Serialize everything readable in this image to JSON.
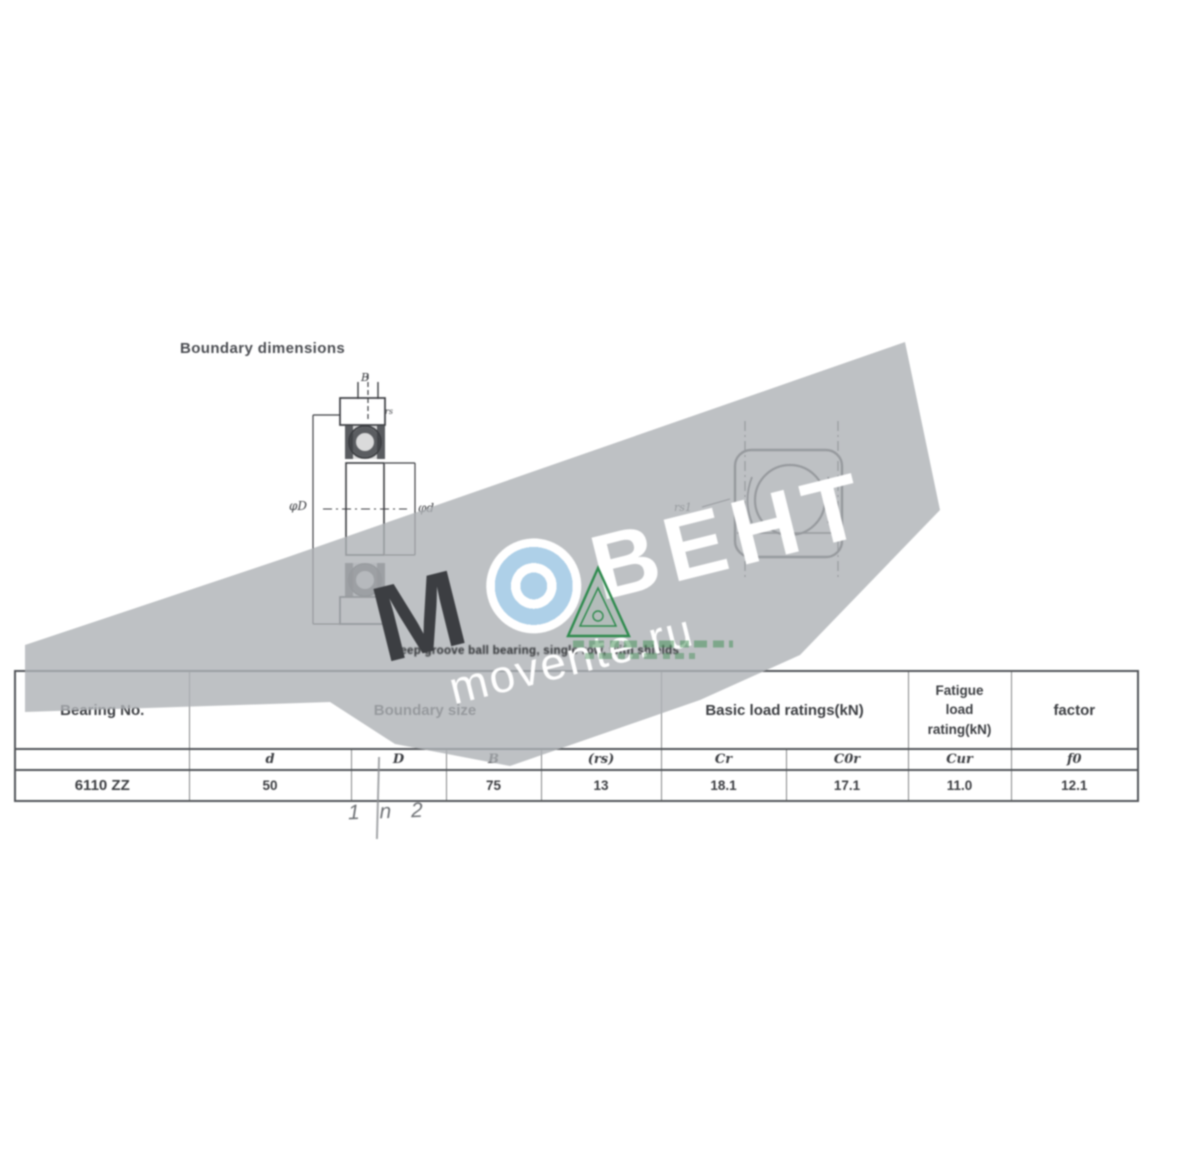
{
  "document": {
    "title": "Boundary dimensions",
    "caption": "deep groove ball bearing, single row, with shields",
    "pencil_note": "1 n 2"
  },
  "watermark": {
    "letter_m": "М",
    "brand": "ВЕНТ",
    "url": "movente.ru",
    "band_color": "#aeb2b5",
    "logo_blue": "#aed0e8",
    "logo_green": "#2f8b4e"
  },
  "drawing_left": {
    "dim_width": "B",
    "dim_outer": "φD",
    "dim_bore": "φd",
    "dim_r": "rs"
  },
  "drawing_right": {
    "dim_r1": "rs1"
  },
  "table": {
    "headers": {
      "bearing_no": "Bearing No.",
      "boundary_size": "Boundary size",
      "basic_load": "Basic load ratings(kN)",
      "fatigue": [
        "Fatigue",
        "load",
        "rating(kN)"
      ],
      "factor": "factor"
    },
    "sub_headers": {
      "d": "d",
      "D": "D",
      "B": "B",
      "rs": "(rs)",
      "cr": "Cr",
      "c0r": "C0r",
      "cur": "Cur",
      "f0": "f0"
    },
    "row": {
      "bearing_no": "6110 ZZ",
      "d": "50",
      "D": "",
      "B": "75",
      "rs": "13",
      "cr": "18.1",
      "c0r": "17.1",
      "cur": "11.0",
      "f0": "12.1"
    }
  }
}
